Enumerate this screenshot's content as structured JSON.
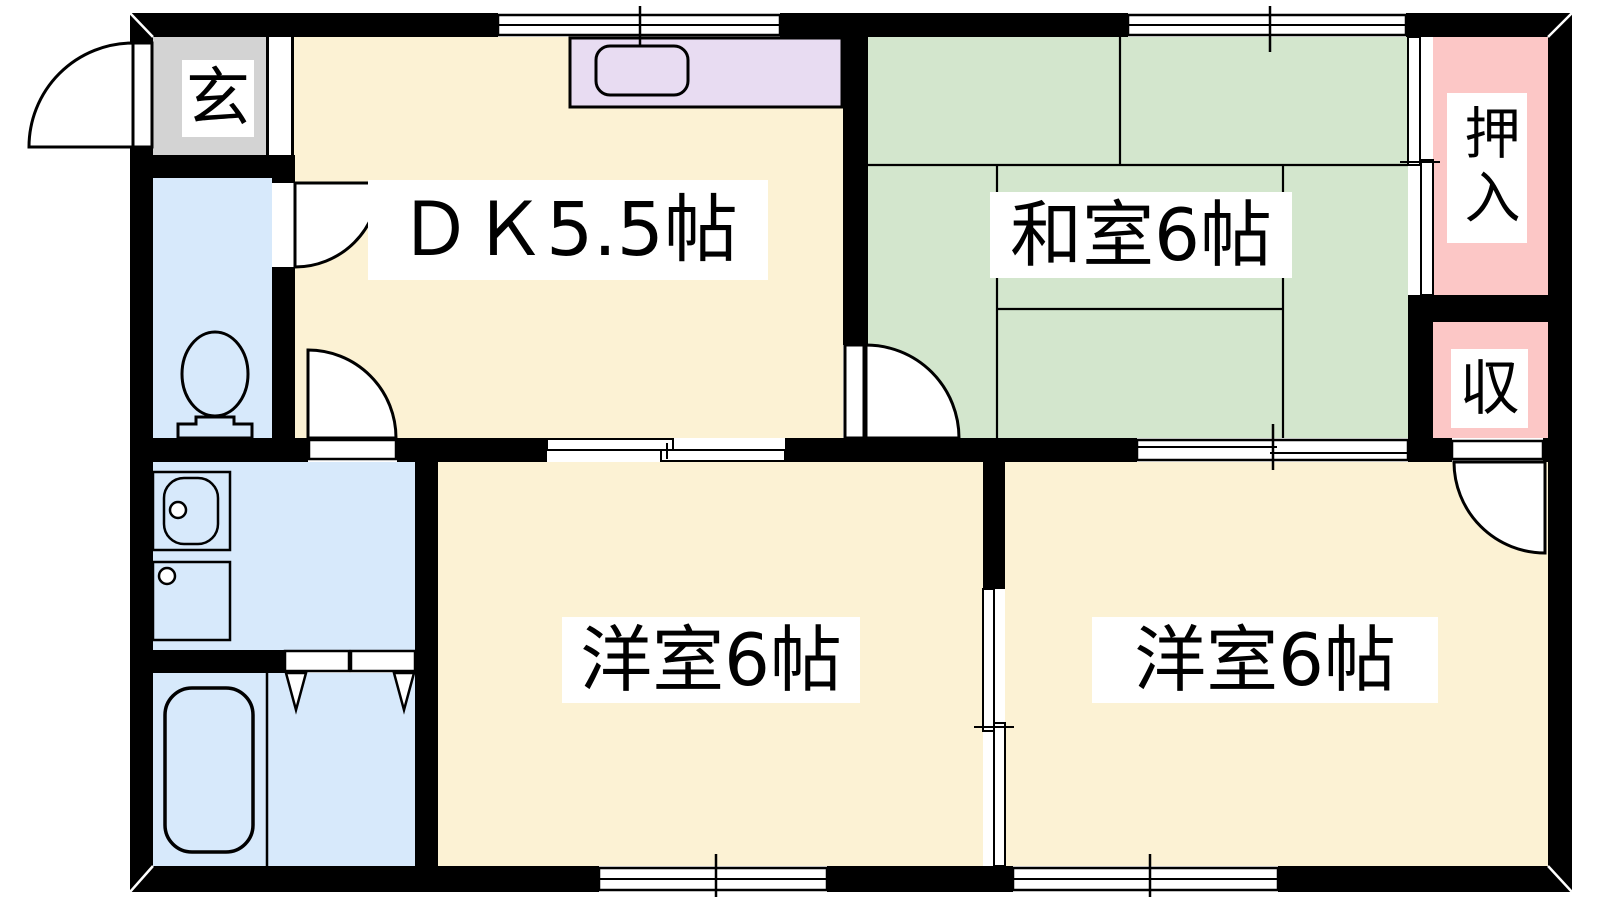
{
  "title": "2DK apartment floor plan",
  "colors": {
    "wall": "#000000",
    "cream": "#FCF2D4",
    "green": "#D3E6CD",
    "blue": "#D7E9FB",
    "pink": "#FCC7C6",
    "purple": "#E8DCF2",
    "gray": "#D3D3D3",
    "paper": "#FFFFFF"
  },
  "rooms": {
    "genkan": {
      "label": "玄",
      "type": "entrance"
    },
    "dk": {
      "label": "ＤＫ5.5帖",
      "type": "dining-kitchen",
      "size_jo": 5.5
    },
    "washitsu": {
      "label": "和室6帖",
      "type": "japanese-room",
      "size_jo": 6
    },
    "bedroom_left": {
      "label": "洋室6帖",
      "type": "western-room",
      "size_jo": 6
    },
    "bedroom_right": {
      "label": "洋室6帖",
      "type": "western-room",
      "size_jo": 6
    },
    "oshiire": {
      "label": "押入",
      "type": "closet"
    },
    "storage": {
      "label": "収",
      "type": "storage"
    }
  },
  "icons": [
    "entrance-door-swing-icon",
    "toilet-icon",
    "washbasin-icon",
    "washing-machine-icon",
    "bathtub-icon",
    "kitchen-sink-icon",
    "window-symbol",
    "sliding-door-symbol",
    "folding-door-symbol",
    "door-swing-arc"
  ]
}
